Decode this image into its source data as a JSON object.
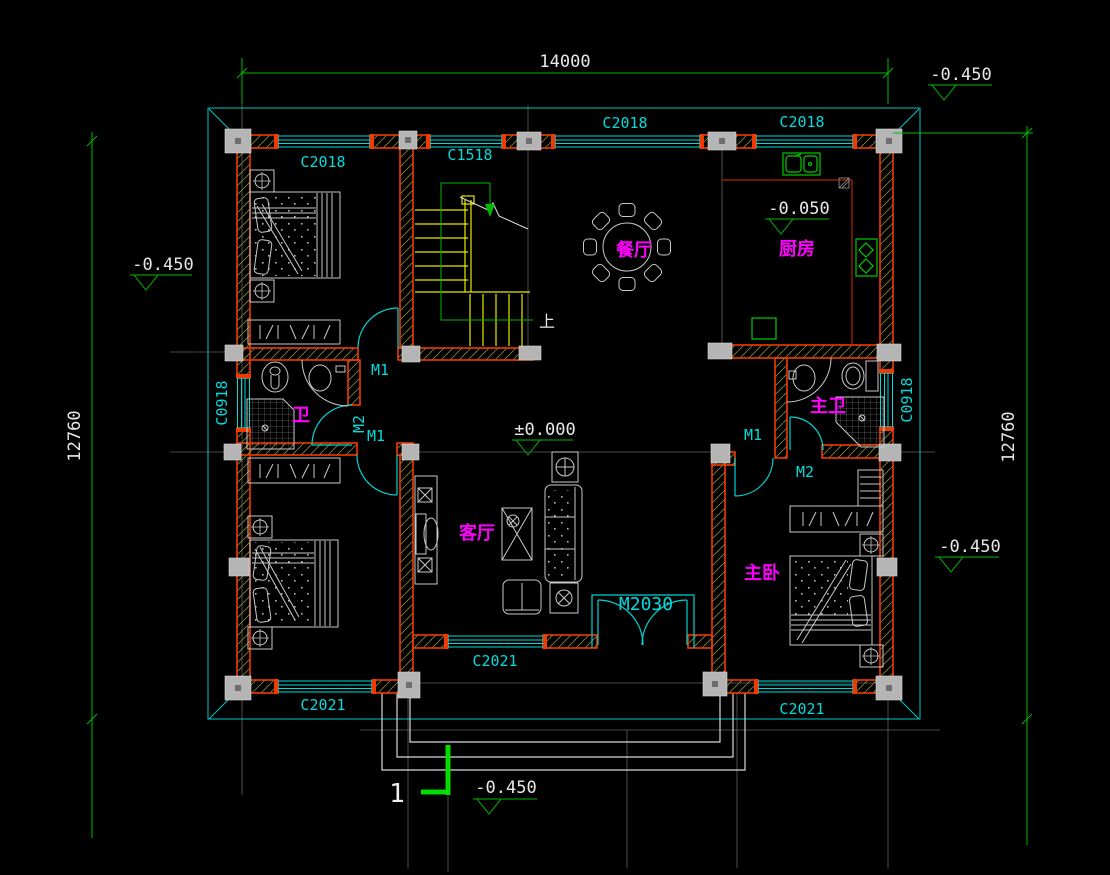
{
  "drawing": {
    "dimensions": {
      "top": "14000",
      "left": "12760",
      "right": "12760"
    },
    "elevations": {
      "top_right": "-0.450",
      "left": "-0.450",
      "right": "-0.450",
      "bottom": "-0.450",
      "kitchen": "-0.050",
      "center": "±0.000"
    },
    "rooms": {
      "dining": "餐厅",
      "kitchen": "厨房",
      "bathroom": "卫",
      "master_bathroom": "主卫",
      "living": "客厅",
      "master_bedroom": "主卧"
    },
    "windows": {
      "c2018_bedroom": "C2018",
      "c1518_stair": "C1518",
      "c2018_dining": "C2018",
      "c2018_kitchen": "C2018",
      "c2021_bedroom2": "C2021",
      "c2021_living": "C2021",
      "c2021_master": "C2021",
      "c0918_left": "C0918",
      "c0918_right": "C0918"
    },
    "doors": {
      "m1_bedroom1": "M1",
      "m2_bath": "M2",
      "m1_bedroom2": "M1",
      "m1_master": "M1",
      "m2_master_bath": "M2",
      "m2030_entrance": "M2030"
    },
    "stairs": {
      "up": "上"
    },
    "section": {
      "number": "1"
    },
    "colors": {
      "background": "#000000",
      "wall": "#f03a02",
      "window_door": "#00dcdc",
      "dimension": "#00bb00",
      "room_label": "#ff00ff",
      "stairs": "#e8e800",
      "furniture": "#c9c9c9",
      "kitchen_fixture": "#00cc00",
      "column": "#b5b5b5",
      "text": "#e8e8e8"
    }
  }
}
